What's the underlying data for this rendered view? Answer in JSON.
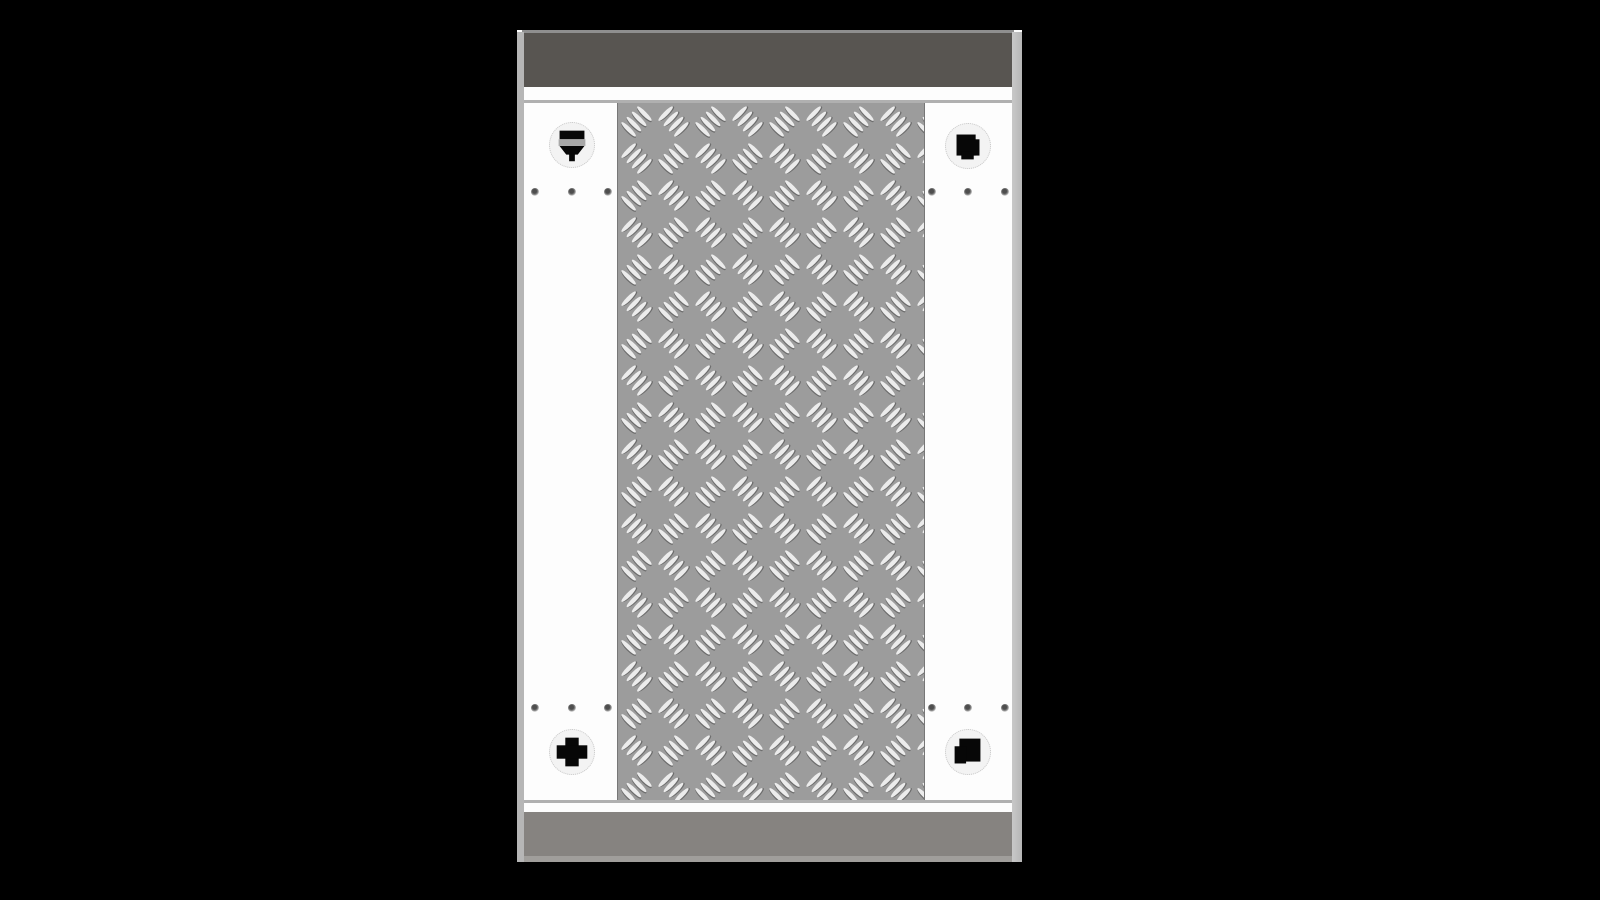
{
  "scene": {
    "kind": "3d-product-render",
    "subject": "top-down view of a platform deck with diamond tread plate centre, white side panels, dark top rail and grey bottom rail on a black backdrop"
  },
  "colors": {
    "backdrop": "#000000",
    "top_rail": "#585551",
    "top_line": "#8f8f8f",
    "rail_divider": "#b0b0b0",
    "edge_strip": "#b6b6b6",
    "panel_white": "#fdfdfd",
    "plate_base": "#9c9c9c",
    "plate_border": "#777777",
    "lens": "#ececec",
    "lens_shadow": "#6d6d6d",
    "hole_ring": "#f3f3f3",
    "hole_ring_border": "#c9c9c9",
    "bolt_black": "#070707",
    "bolt_slot": "#a8a8a8",
    "screw_dot": "#4e4e4e",
    "bottom_rail": "#868380",
    "bottom_lip": "#a09e9b"
  },
  "tread_plate": {
    "pattern": "diamond-plate",
    "cluster_ovals": 4,
    "orientation": "alternating 45deg checkerboard"
  },
  "anchor_holes": [
    {
      "id": "top-left",
      "insert": "slotted-bolt-head"
    },
    {
      "id": "top-right",
      "insert": "clover-bolt-cutout"
    },
    {
      "id": "bottom-left",
      "insert": "cross-bolt-cutout"
    },
    {
      "id": "bottom-right",
      "insert": "square-bolt-cutout"
    }
  ],
  "screws": {
    "total": 12,
    "groups": 4,
    "per_group": 3
  }
}
